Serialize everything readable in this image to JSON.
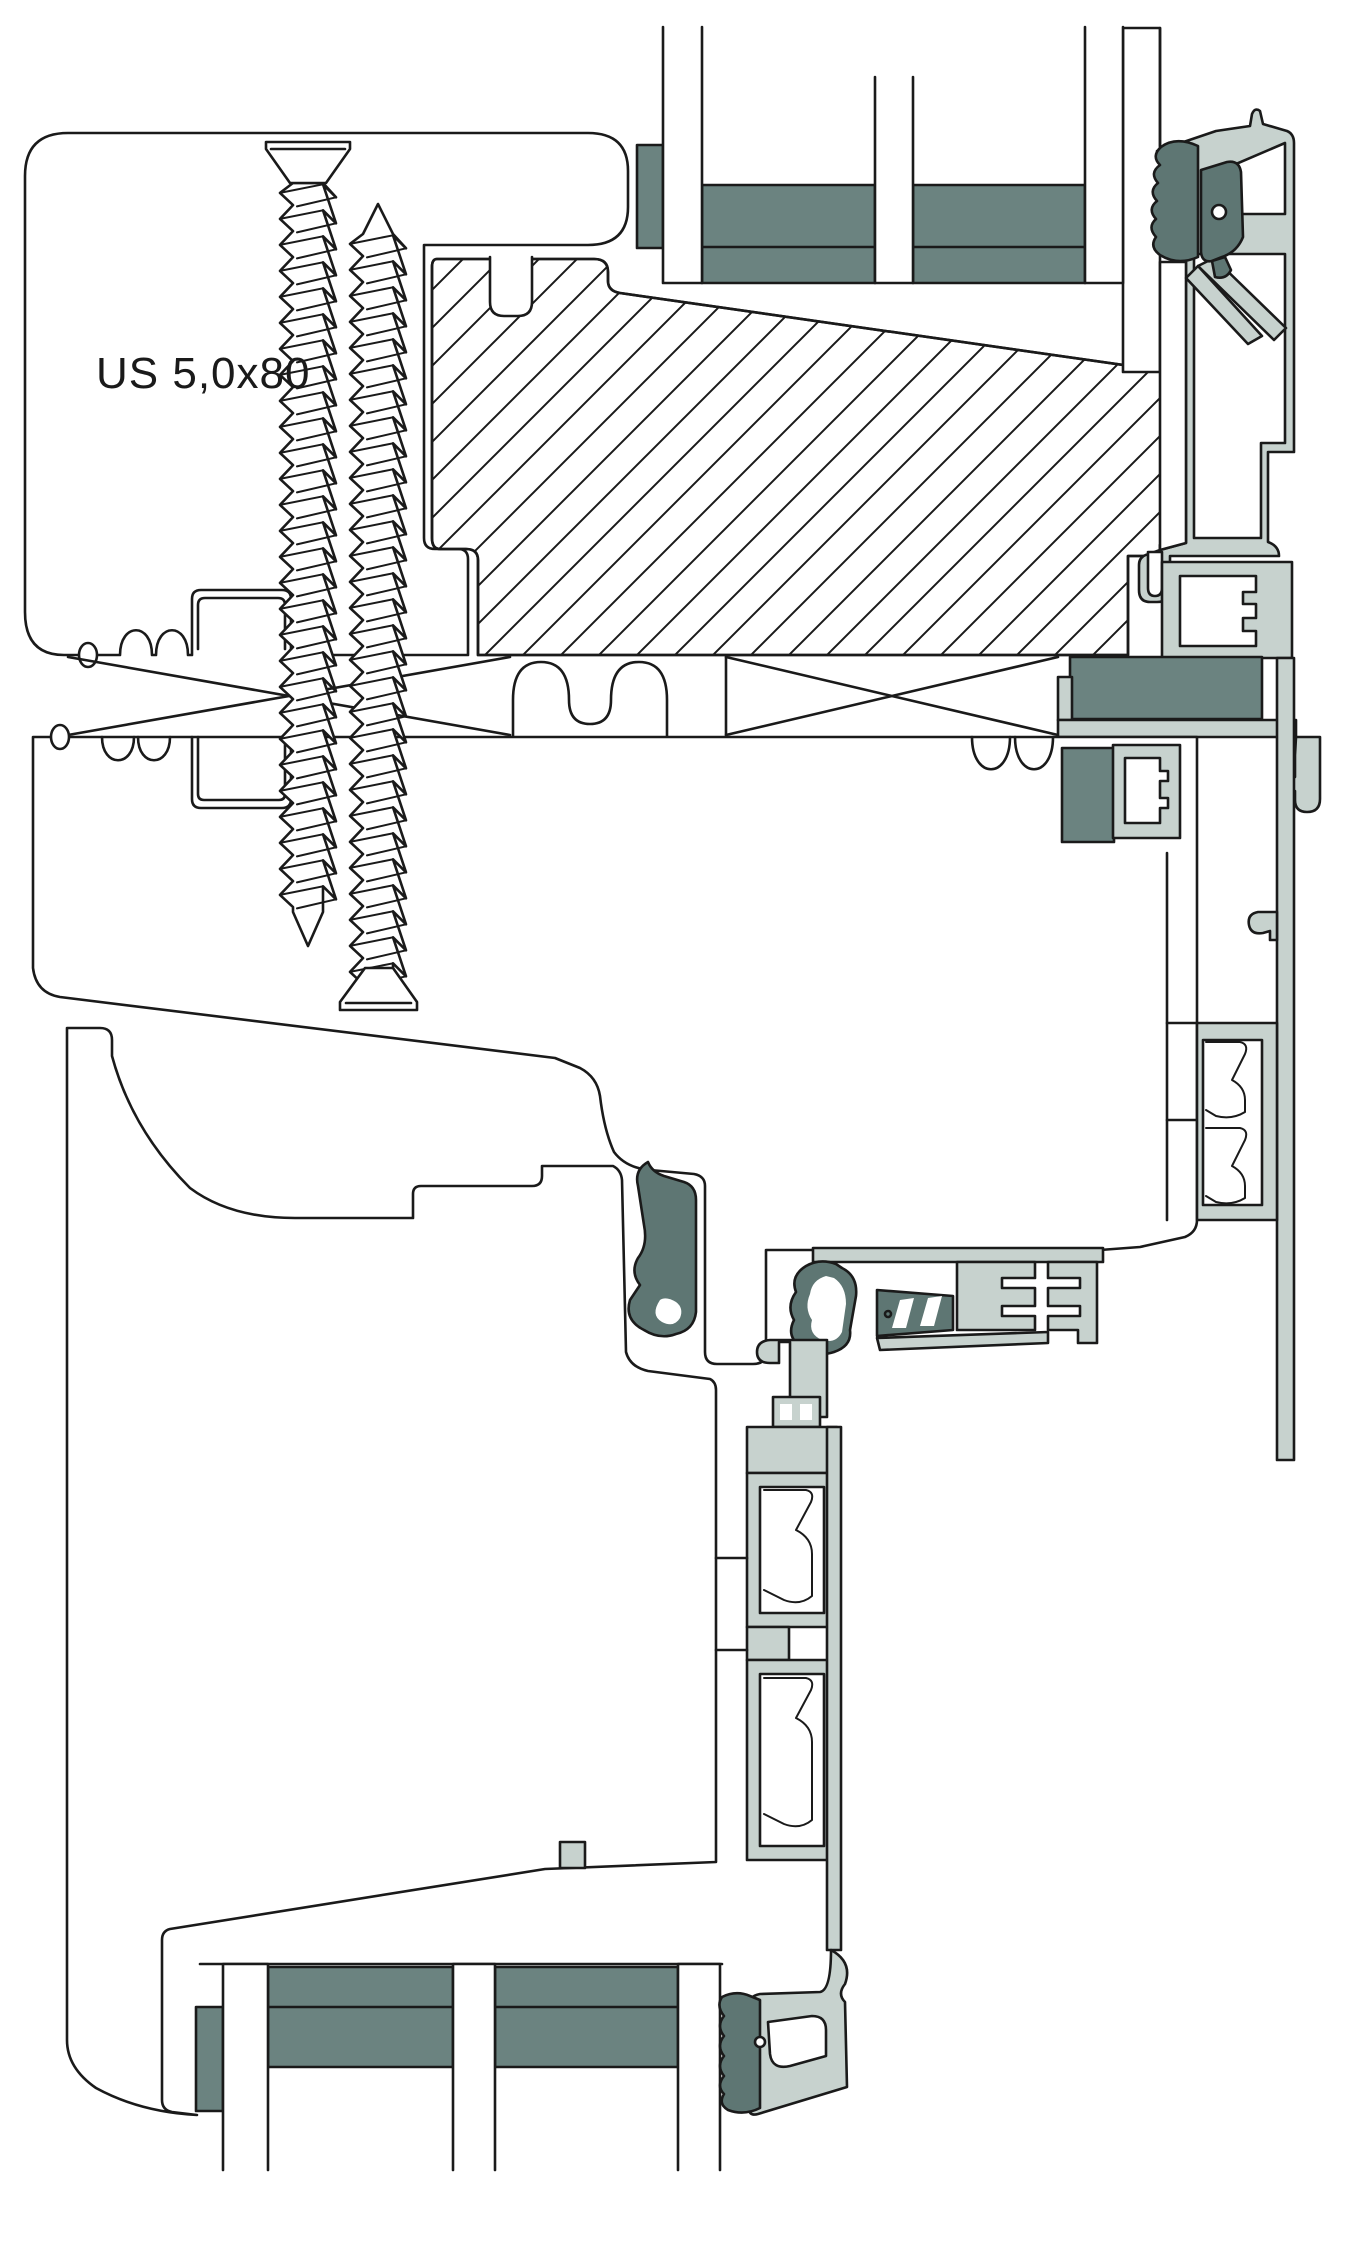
{
  "diagram": {
    "label": "US 5,0x80"
  },
  "colors": {
    "ink": "#1a1a1a",
    "alu": "#c7d2ce",
    "sealant": "#6b8380",
    "gasket": "#5e7673",
    "paper": "#ffffff"
  }
}
